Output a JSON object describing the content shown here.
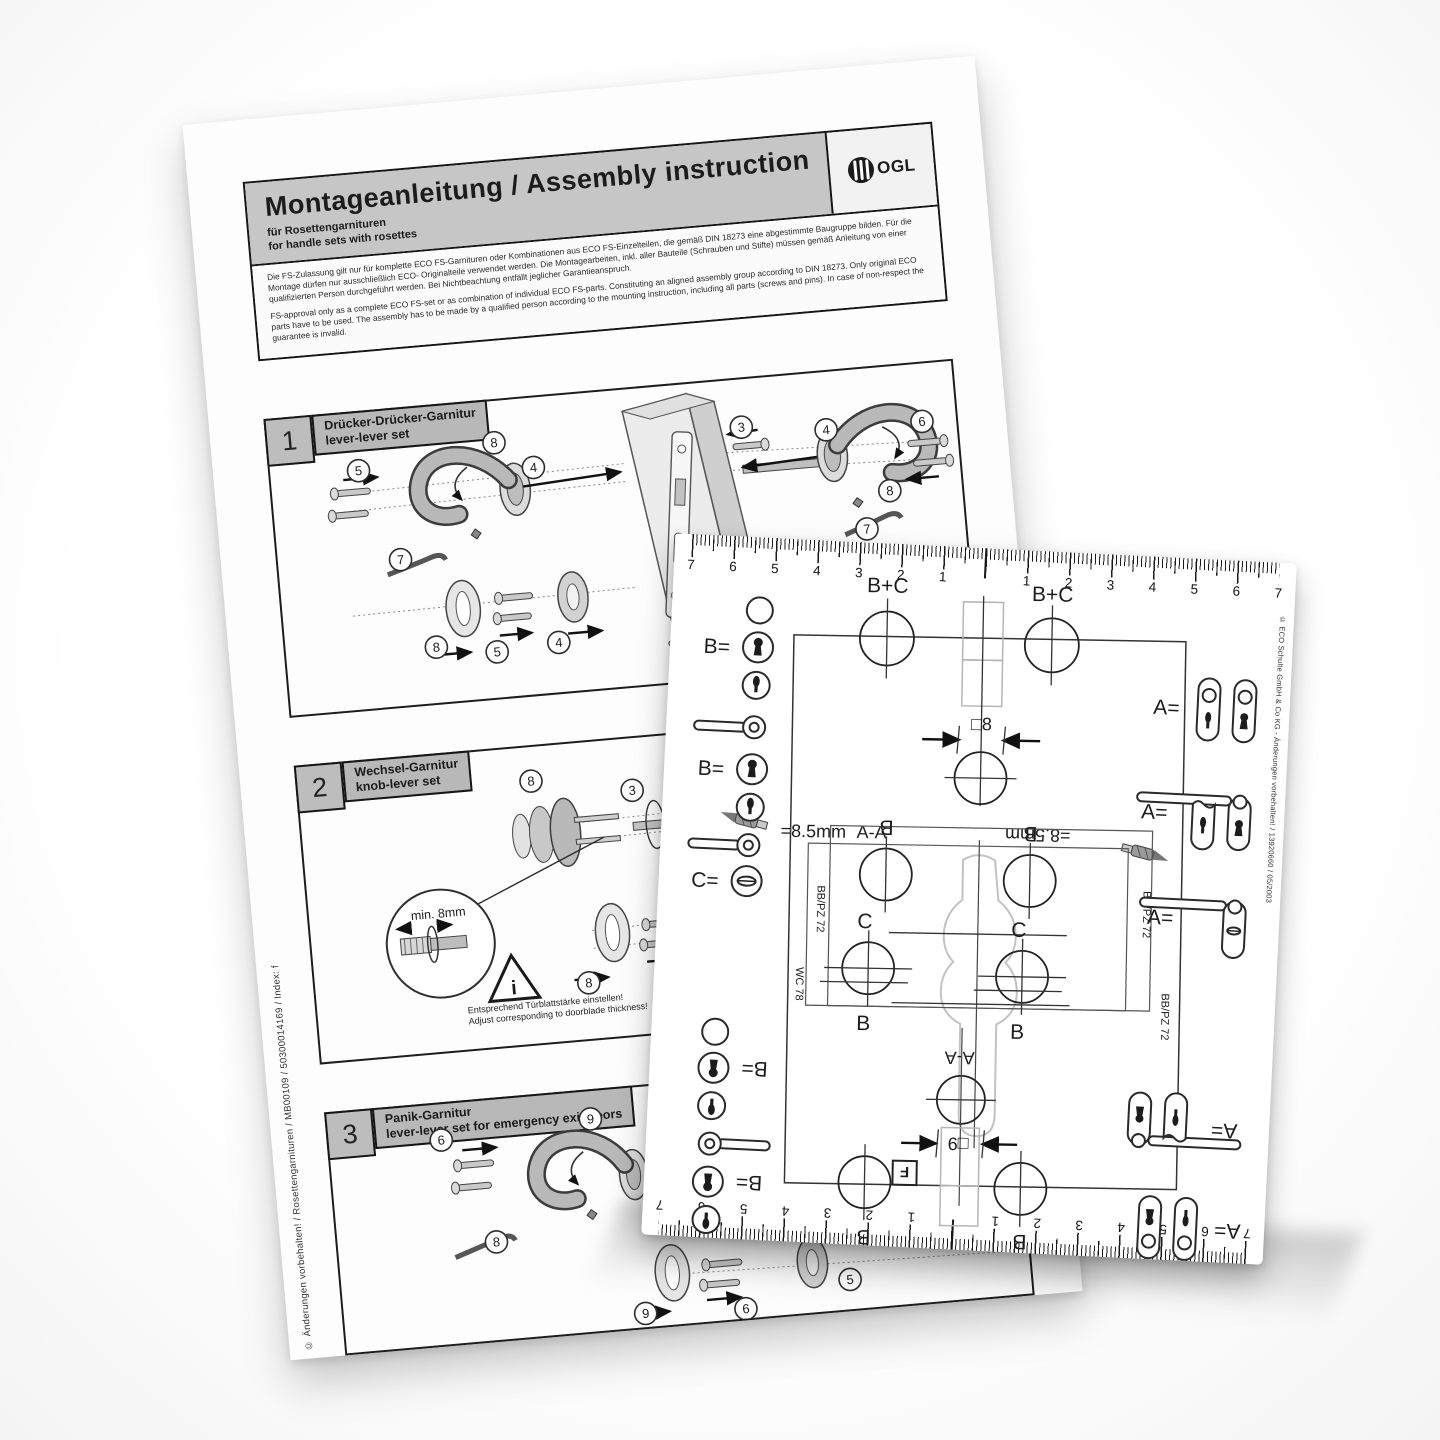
{
  "back_doc": {
    "header": {
      "title": "Montageanleitung / Assembly instruction",
      "subtitle_de": "für Rosettengarnituren",
      "subtitle_en": "for handle sets with rosettes",
      "logo_text": "OGL"
    },
    "intro_de": "Die FS-Zulassung gilt nur für komplette ECO FS-Garnituren oder Kombinationen aus ECO FS-Einzelteilen, die gemäß DIN 18273 eine abgestimmte Baugruppe bilden. Für die Montage dürfen nur ausschließlich ECO- Originalteile verwendet werden. Die Montagearbeiten, inkl. aller Bauteile (Schrauben und Stifte) müssen gemäß Anleitung von einer qualifizierten Person durchgeführt werden. Bei Nichtbeachtung entfällt jeglicher Garantieanspruch.",
    "intro_en": "FS-approval only as a complete ECO FS-set or as combination of individual ECO FS-parts. Constituting an aligned assembly group according to DIN 18273. Only original ECO parts have to be used. The assembly has to be made by a qualified person according to the mounting instruction, including all parts (screws and pins). In case of non-respect the guarantee is invalid.",
    "side_note": "© Änderungen vorbehalten! / Rosettengarnituren / MB00109 / 50300014169 / Index: f",
    "sections": [
      {
        "num": "1",
        "title_de": "Drücker-Drücker-Garnitur",
        "title_en": "lever-lever set",
        "callouts": [
          "8",
          "5",
          "7",
          "4",
          "8",
          "5",
          "4",
          "3",
          "1",
          "2",
          "4",
          "6",
          "8",
          "7"
        ]
      },
      {
        "num": "2",
        "title_de": "Wechsel-Garnitur",
        "title_en": "knob-lever set",
        "detail_label": "min. 8mm",
        "warn": "i",
        "note_de": "Entsprechend Türblattstärke einstellen!",
        "note_en": "Adjust corresponding to doorblade thickness!",
        "callouts": [
          "8",
          "3",
          "4",
          "8",
          "6",
          "4"
        ]
      },
      {
        "num": "3",
        "title_de": "Panik-Garnitur",
        "title_en": "lever-lever set for emergency exit doors",
        "callouts": [
          "9",
          "6",
          "5",
          "4",
          "8",
          "9",
          "6",
          "5"
        ]
      }
    ]
  },
  "template_card": {
    "ruler_numbers": [
      "7",
      "6",
      "5",
      "4",
      "3",
      "2",
      "1",
      "1",
      "2",
      "3",
      "4",
      "5",
      "6",
      "7"
    ],
    "labels": {
      "a": "A=",
      "b": "B=",
      "c": "C=",
      "bc": "B+C",
      "hole_b": "B",
      "hole_c": "C",
      "sq8": "□8",
      "sq9": "□9",
      "drill": "=8.5mm",
      "section": "A-A",
      "f": "F",
      "wc78": "WC 78",
      "bbpz72": "BB/PZ 72"
    },
    "side_note": "© ECO Schulte GmbH & Co KG - Änderungen vorbehalten! / 13920660 / 05/2003"
  }
}
